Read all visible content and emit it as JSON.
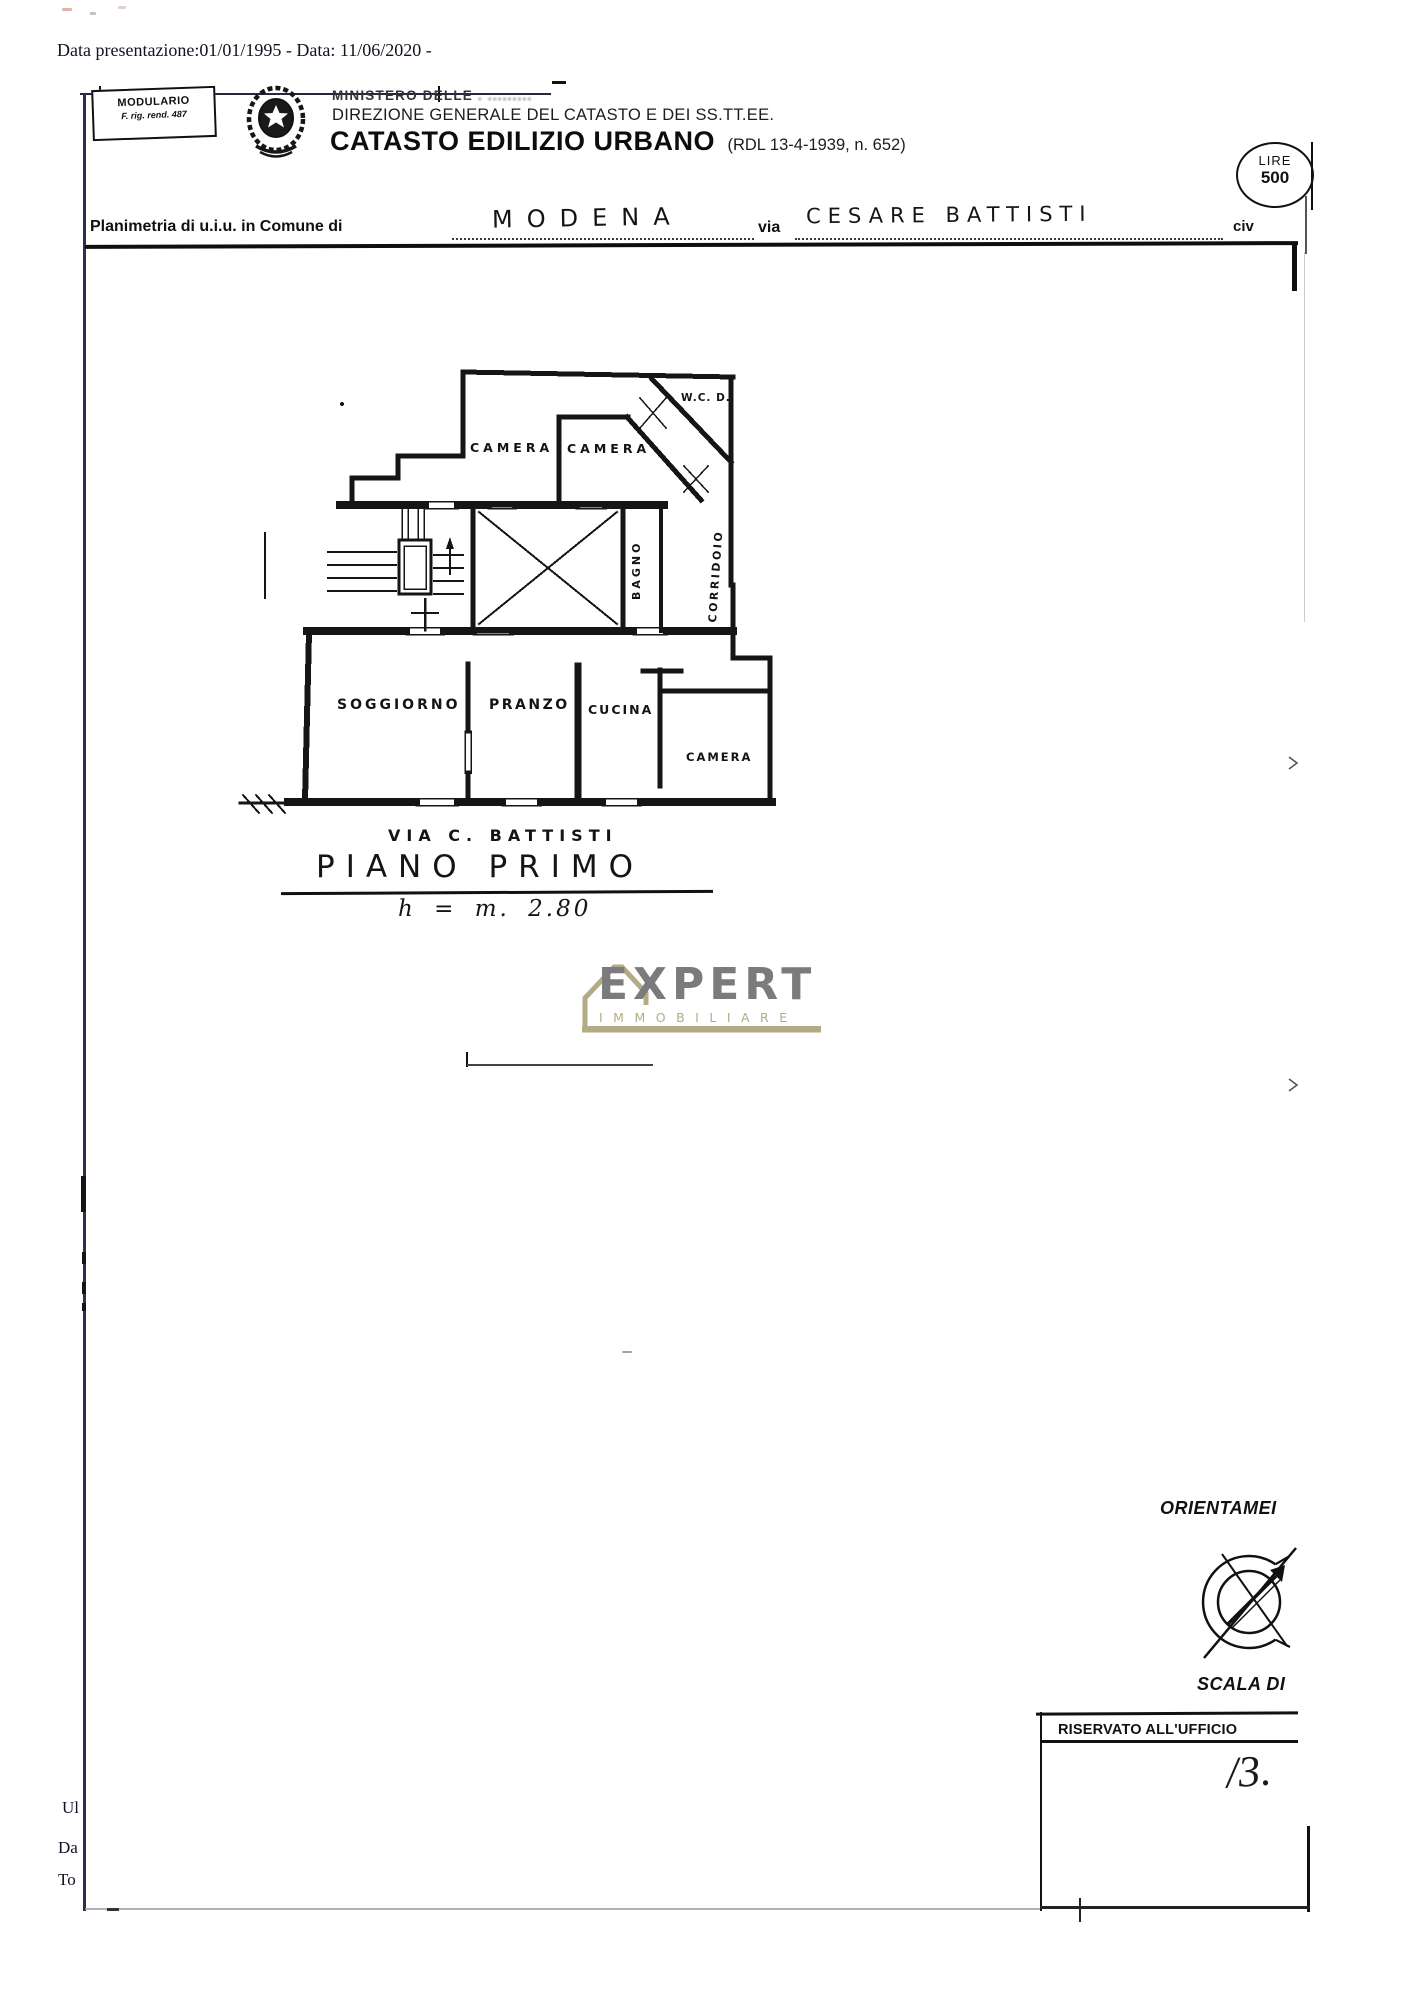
{
  "date_line": "Data presentazione:01/01/1995 - Data: 11/06/2020 -",
  "modulario": {
    "line1": "MODULARIO",
    "line2": "F. rig. rend. 487"
  },
  "header": {
    "ministero": "MINISTERO DELLE",
    "ministero_smudge": ". .........",
    "direzione": "DIREZIONE GENERALE DEL CATASTO E DEI SS.TT.EE.",
    "catasto_title": "CATASTO EDILIZIO URBANO",
    "catasto_ref": "(RDL 13-4-1939, n. 652)",
    "stamp_line1": "LIRE",
    "stamp_line2": "500"
  },
  "planimetria": {
    "label": "Planimetria di u.i.u. in Comune di",
    "comune": "MODENA",
    "via_label": "via",
    "via_value": "CESARE BATTISTI",
    "civ_label": "civ"
  },
  "plan": {
    "rooms": {
      "camera1": "CAMERA",
      "camera2": "CAMERA",
      "wc": "W.C. D.",
      "bagno": "BAGNO",
      "corridoio": "CORRIDOIO",
      "soggiorno": "SOGGIORNO",
      "pranzo": "PRANZO",
      "cucina": "CUCINA",
      "camera3": "CAMERA"
    },
    "street": "VIA C. BATTISTI",
    "floor": "PIANO PRIMO",
    "height": "h = m. 2.80"
  },
  "watermark": {
    "brand": "EXPERT",
    "sub": "IMMOBILIARE",
    "house_color": "#b3ab84",
    "text_color": "#7b7b7e"
  },
  "orientation_label": "ORIENTAMEI",
  "scale_label": "SCALA DI",
  "office_box": {
    "title": "RISERVATO ALL'UFFICIO",
    "handwritten": "/3."
  },
  "bottom_left": {
    "l1": "Ul",
    "l2": "Da",
    "l3": "To"
  }
}
